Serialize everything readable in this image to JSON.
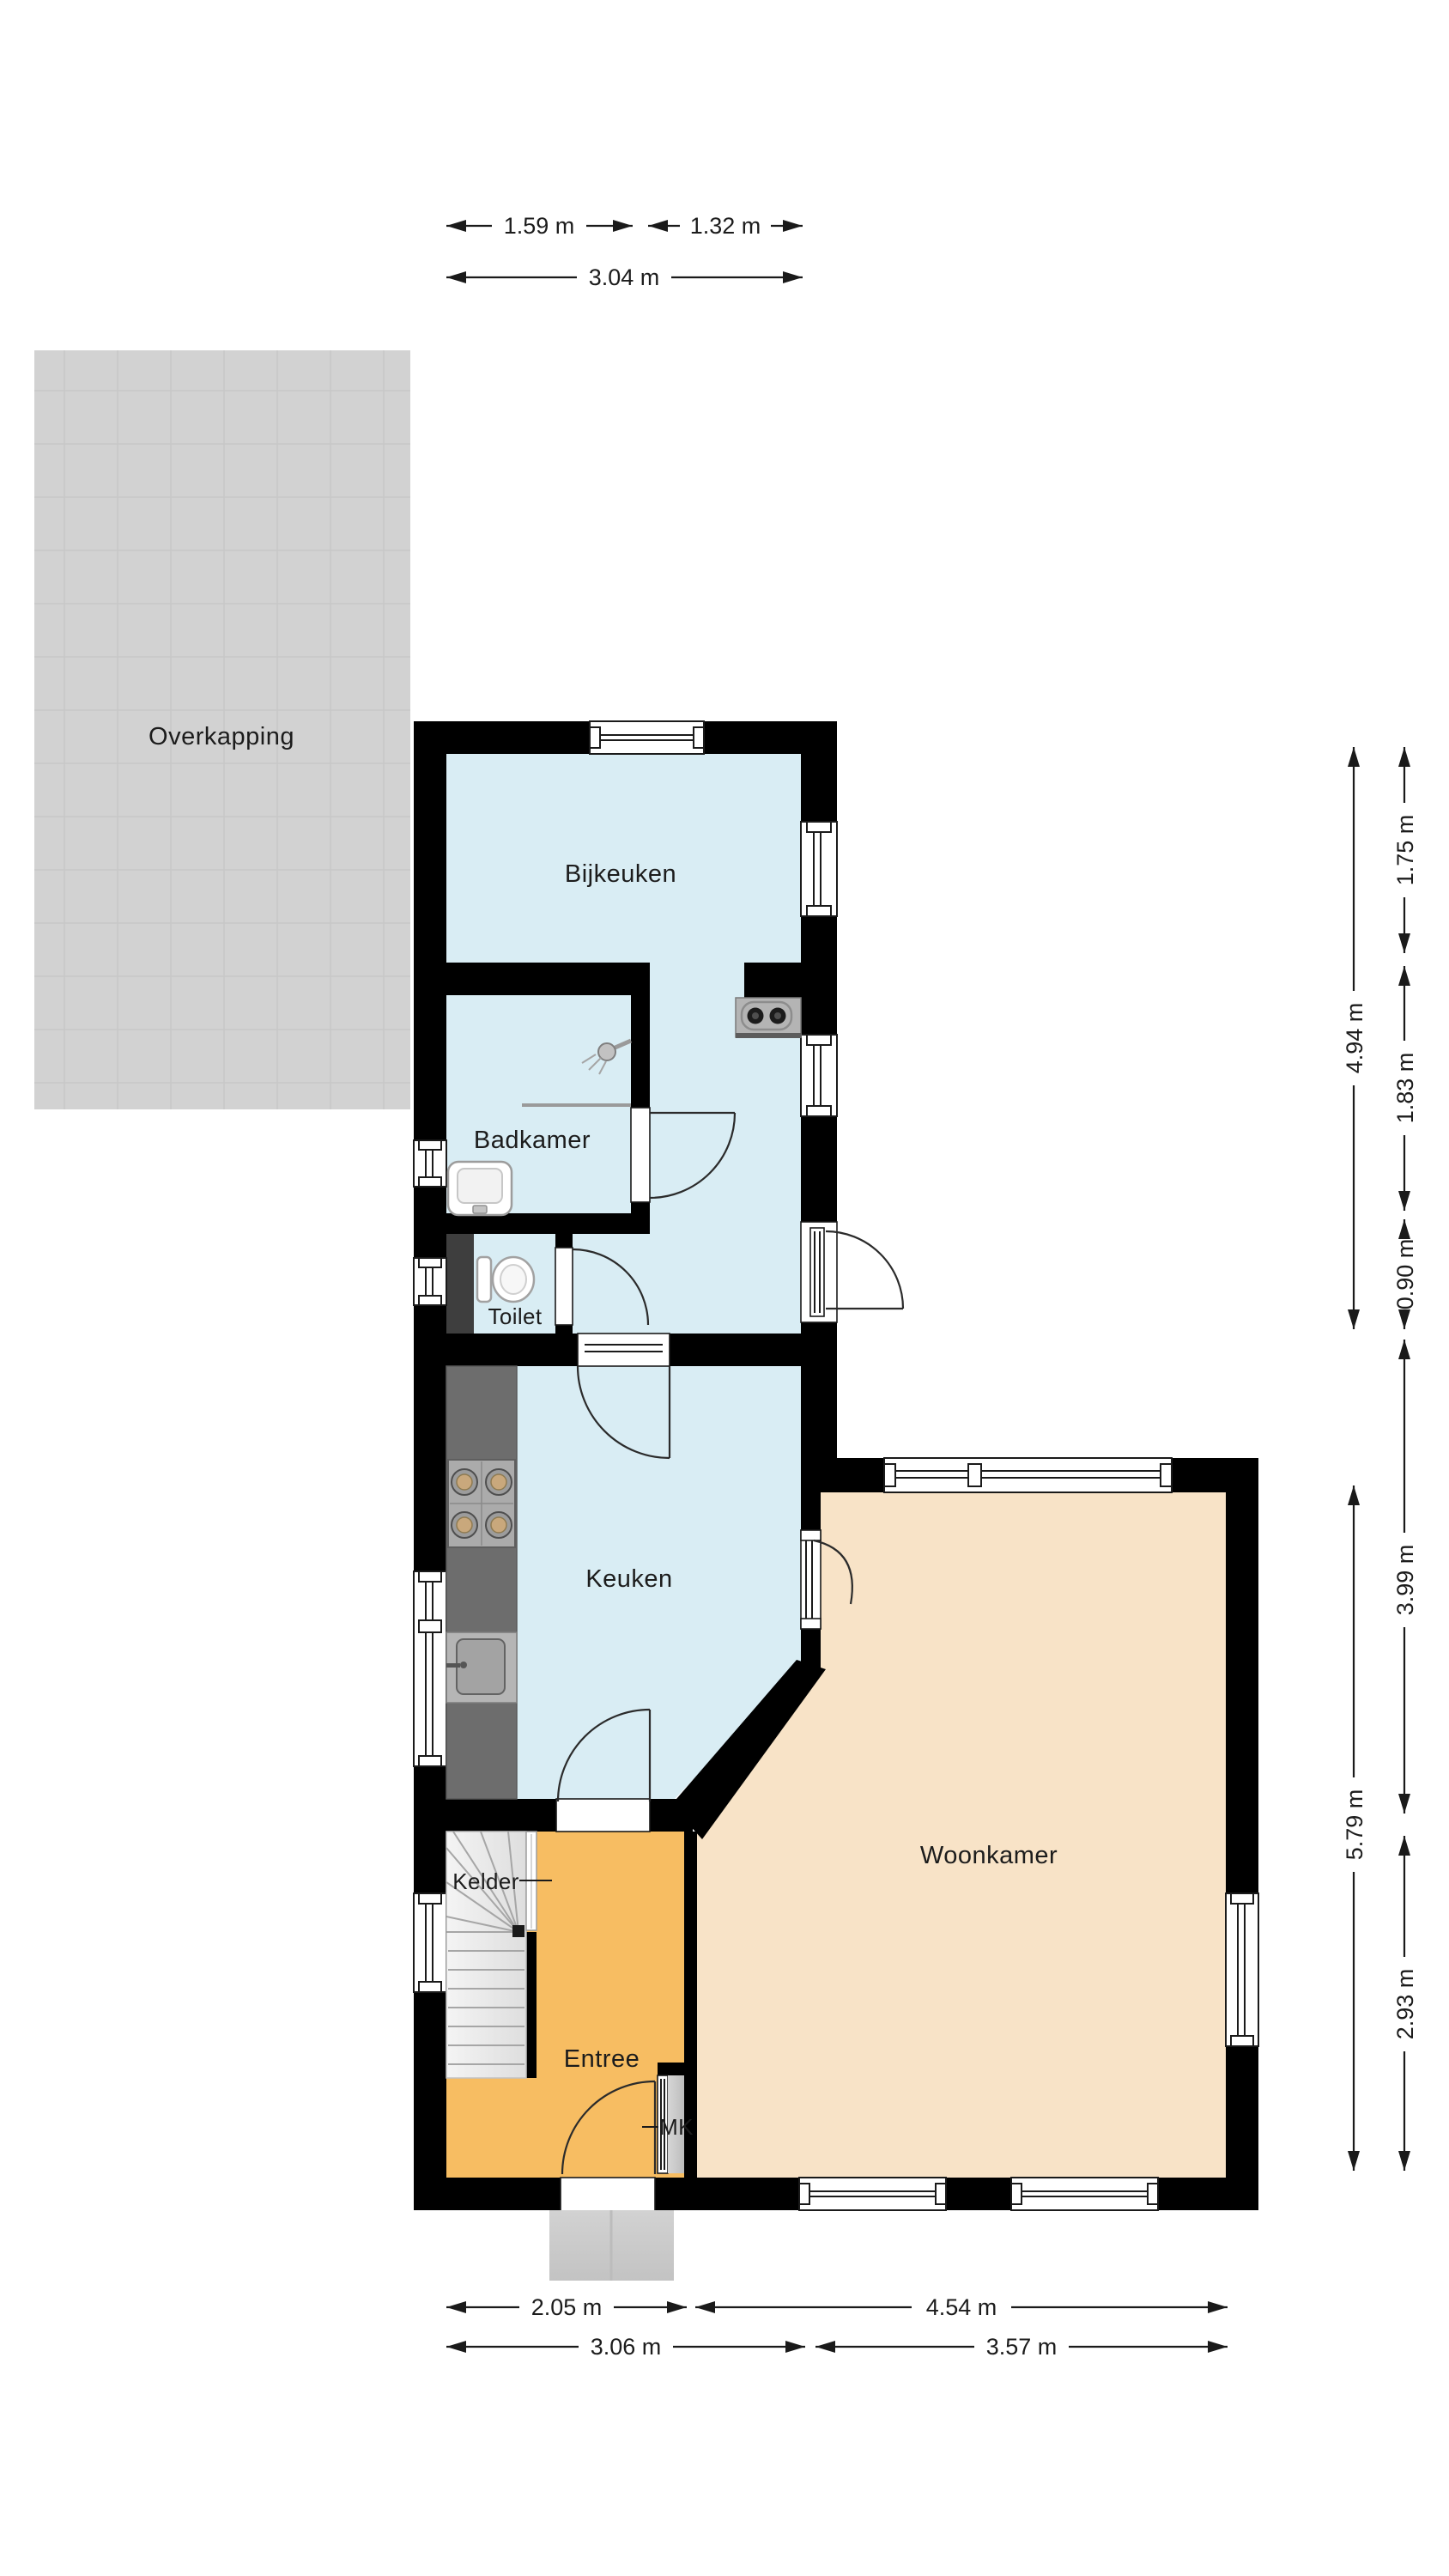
{
  "floorplan": {
    "rooms": {
      "overkapping": {
        "label": "Overkapping",
        "type": "canopy"
      },
      "bijkeuken": {
        "label": "Bijkeuken",
        "type": "utility-room"
      },
      "badkamer": {
        "label": "Badkamer",
        "type": "bathroom"
      },
      "toilet": {
        "label": "Toilet",
        "type": "toilet"
      },
      "keuken": {
        "label": "Keuken",
        "type": "kitchen"
      },
      "woonkamer": {
        "label": "Woonkamer",
        "type": "living-room"
      },
      "kelder": {
        "label": "Kelder",
        "type": "cellar-stairs"
      },
      "entree": {
        "label": "Entree",
        "type": "hall"
      },
      "mk": {
        "label": "MK",
        "type": "meter-cupboard"
      }
    },
    "dimensions": {
      "top": [
        "1.59 m",
        "1.32 m",
        "3.04 m"
      ],
      "right": [
        "1.75 m",
        "1.83 m",
        "0.90 m",
        "4.94 m",
        "3.99 m",
        "2.93 m",
        "5.79 m"
      ],
      "bottom": [
        "2.05 m",
        "4.54 m",
        "3.06 m",
        "3.57 m"
      ]
    },
    "colors": {
      "wall": "#000000",
      "wet_rooms_floor": "#d9edf4",
      "living_room_floor": "#f8e3c7",
      "hall_floor": "#f7bd62",
      "canopy": "#d2d2d2",
      "counter": "#6d6d6d"
    },
    "icons": [
      "stove-icon",
      "sink-icon",
      "washbasin-icon",
      "toilet-icon",
      "shower-icon",
      "washer-icon",
      "stairs-icon",
      "window",
      "door"
    ]
  }
}
